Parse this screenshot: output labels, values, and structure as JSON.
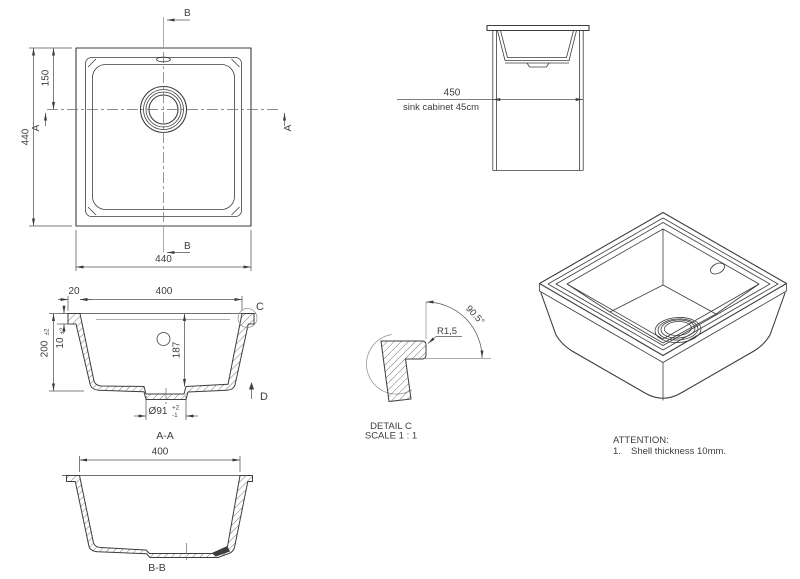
{
  "top_view": {
    "dim_side": "440",
    "dim_width": "440",
    "dim_drain": "150",
    "marker_b": "B",
    "marker_a": "A"
  },
  "cabinet_view": {
    "dim_width": "450",
    "caption": "sink cabinet 45cm"
  },
  "section_aa": {
    "label": "A-A",
    "dim_rim": "20",
    "dim_width": "400",
    "dim_height": "200",
    "dim_height_tol": "±2",
    "dim_rim_h": "10",
    "dim_rim_h_tol": "±2",
    "dim_depth": "187",
    "dim_drain": "Ø91",
    "dim_drain_tol_up": "+2",
    "dim_drain_tol_dn": "-1",
    "marker_c": "C",
    "marker_d": "D"
  },
  "detail_c": {
    "radius": "R1,5",
    "angle": "90.5°",
    "title": "DETAIL C",
    "scale": "SCALE 1 : 1"
  },
  "section_bb": {
    "label": "B-B",
    "dim_width": "400"
  },
  "notes": {
    "title": "ATTENTION:",
    "num": "1.",
    "text": "Shell thickness 10mm."
  }
}
